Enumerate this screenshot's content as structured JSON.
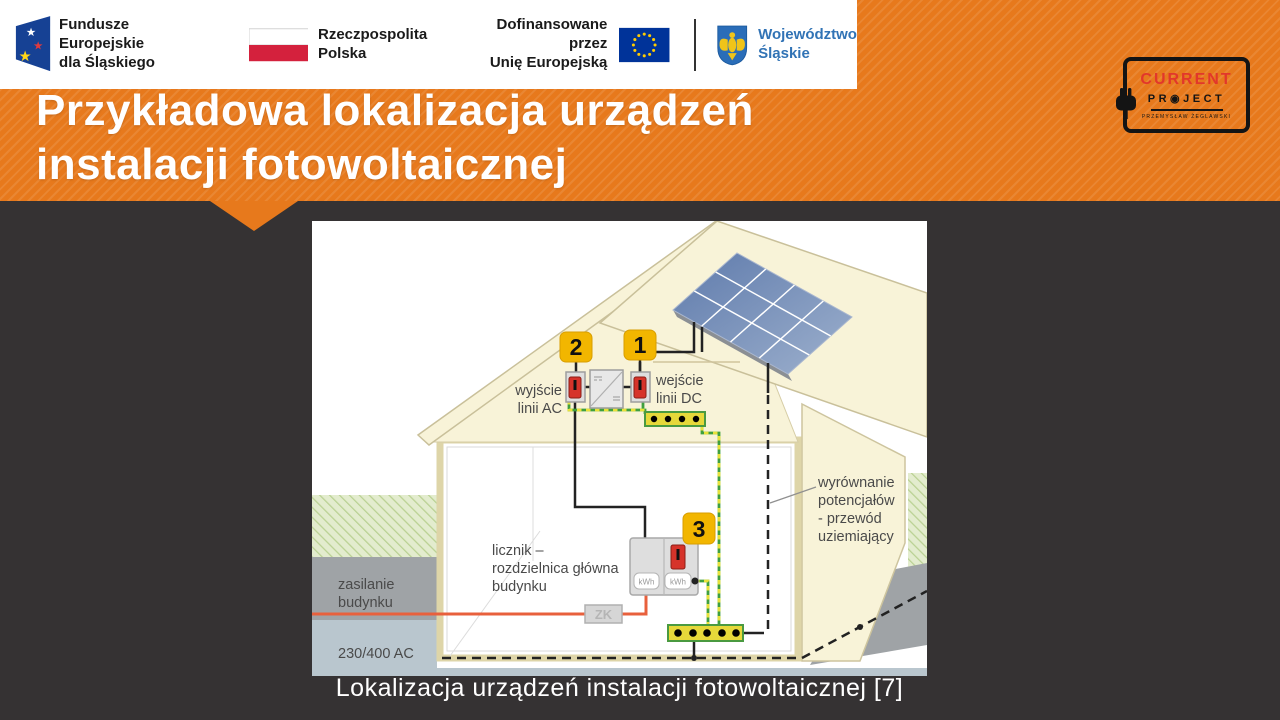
{
  "slide": {
    "background": "#353233",
    "accent_orange": "#e7791c"
  },
  "logo_bar": {
    "eu_funds": {
      "line1": "Fundusze Europejskie",
      "line2": "dla Śląskiego"
    },
    "poland": {
      "line1": "Rzeczpospolita",
      "line2": "Polska"
    },
    "eu_funding": {
      "line1": "Dofinansowane przez",
      "line2": "Unię Europejską"
    },
    "silesia": {
      "line1": "Województwo",
      "line2": "Śląskie"
    }
  },
  "title": {
    "line1": "Przykładowa lokalizacja urządzeń",
    "line2": "instalacji fotowoltaicznej"
  },
  "project_logo": {
    "name": "CURRENT",
    "word": "PR◉JECT",
    "subtitle": "PRZEMYSŁAW ŻEGLAWSKI"
  },
  "diagram": {
    "badge_1": "1",
    "badge_2": "2",
    "badge_3": "3",
    "dc_input": {
      "line1": "wejście",
      "line2": "linii DC"
    },
    "ac_output": {
      "line1": "wyjście",
      "line2": "linii AC"
    },
    "meter": {
      "line1": "licznik –",
      "line2": "rozdzielnica główna",
      "line3": "budynku"
    },
    "supply": {
      "line1": "zasilanie",
      "line2": "budynku"
    },
    "voltage": "230/400 AC",
    "zk_box": "ZK",
    "kwh_left": "kWh",
    "kwh_right": "kWh",
    "grounding": {
      "line1": "wyrównanie",
      "line2": "potencjałów",
      "line3": "- przewód",
      "line4": "uziemiający"
    },
    "colors": {
      "badge_yellow": "#f2b600",
      "panel_blue": "#6580ac",
      "wire_orange": "#e8603c",
      "pe_green": "#3f9f3f",
      "pe_yellow": "#e8e23a",
      "roof_cream": "#f8f3d8"
    }
  },
  "caption": "Lokalizacja urządzeń instalacji fotowoltaicznej [7]"
}
